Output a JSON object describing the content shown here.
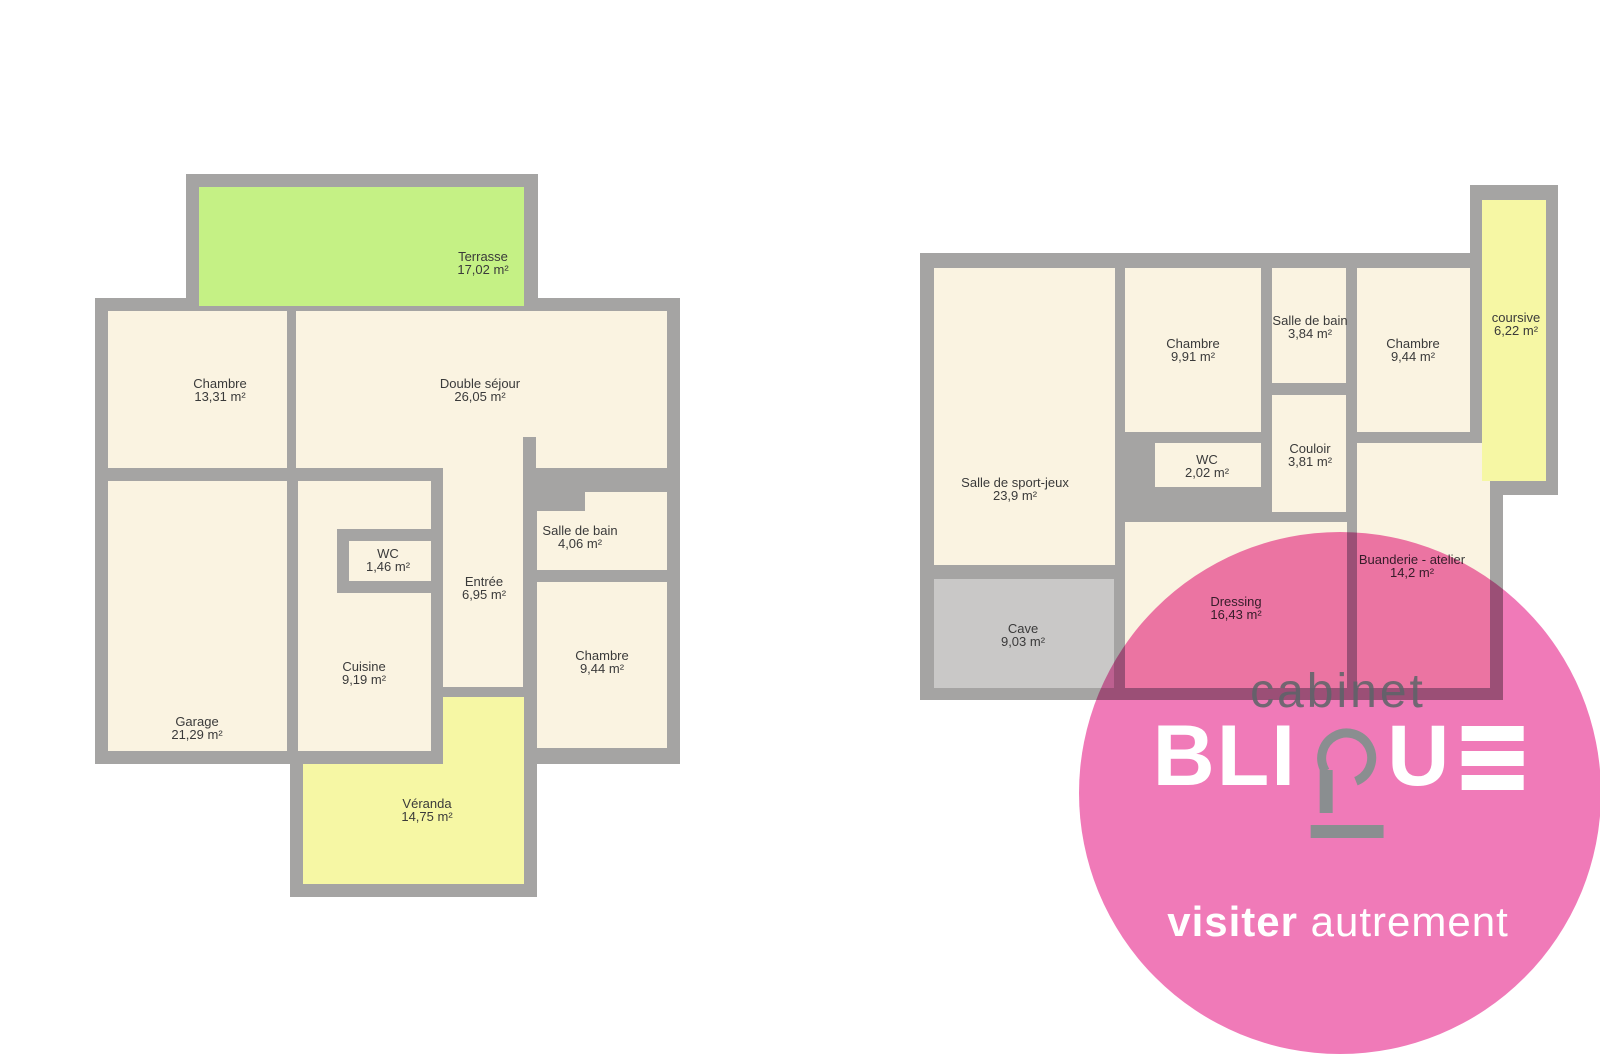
{
  "palette": {
    "wall": "#a5a4a3",
    "room": "#faf3e1",
    "terrace_green": "#c5f185",
    "veranda_yellow": "#f6f7a4",
    "cave_gray": "#c9c8c7",
    "label_text": "#3a3a3a",
    "watermark_pink": "#f07ab8",
    "logo_gray": "#8a8e90",
    "cabinet_text": "#5c6468",
    "logo_white": "#ffffff"
  },
  "floorplans": [
    {
      "id": "plan-left",
      "backings": [
        [
          186,
          174,
          352,
          137
        ],
        [
          95,
          298,
          585,
          466
        ],
        [
          290,
          684,
          247,
          213
        ]
      ],
      "fills": [
        {
          "rect": [
            199,
            187,
            325,
            119
          ],
          "color": "terrace_green"
        },
        {
          "rect": [
            108,
            311,
            179,
            157
          ],
          "color": "room"
        },
        {
          "rect": [
            296,
            311,
            371,
            157
          ],
          "color": "room"
        },
        {
          "rect": [
            108,
            481,
            179,
            270
          ],
          "color": "room"
        },
        {
          "rect": [
            298,
            481,
            133,
            270
          ],
          "color": "room"
        },
        {
          "rect": [
            443,
            468,
            80,
            219
          ],
          "color": "room"
        },
        {
          "rect": [
            537,
            492,
            130,
            78
          ],
          "color": "room"
        },
        {
          "rect": [
            537,
            582,
            130,
            166
          ],
          "color": "room"
        },
        {
          "rect": [
            443,
            697,
            81,
            67
          ],
          "color": "veranda_yellow"
        },
        {
          "rect": [
            303,
            764,
            221,
            120
          ],
          "color": "veranda_yellow"
        }
      ],
      "overlay_walls": [
        [
          337,
          529,
          12,
          64
        ],
        [
          337,
          529,
          94,
          12
        ],
        [
          337,
          581,
          94,
          12
        ],
        [
          523,
          437,
          13,
          31
        ],
        [
          537,
          492,
          48,
          19
        ]
      ],
      "rooms": [
        {
          "name": "Terrasse",
          "area": "17,02 m²",
          "x": 483,
          "y": 251
        },
        {
          "name": "Chambre",
          "area": "13,31 m²",
          "x": 220,
          "y": 378
        },
        {
          "name": "Double séjour",
          "area": "26,05 m²",
          "x": 480,
          "y": 378
        },
        {
          "name": "WC",
          "area": "1,46 m²",
          "x": 388,
          "y": 548
        },
        {
          "name": "Salle de bain",
          "area": "4,06 m²",
          "x": 580,
          "y": 525
        },
        {
          "name": "Entrée",
          "area": "6,95 m²",
          "x": 484,
          "y": 576
        },
        {
          "name": "Cuisine",
          "area": "9,19 m²",
          "x": 364,
          "y": 661
        },
        {
          "name": "Chambre",
          "area": "9,44 m²",
          "x": 602,
          "y": 650
        },
        {
          "name": "Garage",
          "area": "21,29 m²",
          "x": 197,
          "y": 716
        },
        {
          "name": "Véranda",
          "area": "14,75 m²",
          "x": 427,
          "y": 798
        }
      ]
    },
    {
      "id": "plan-right",
      "backings": [
        [
          920,
          253,
          583,
          447
        ],
        [
          1470,
          185,
          88,
          310
        ]
      ],
      "fills": [
        {
          "rect": [
            934,
            268,
            181,
            297
          ],
          "color": "room"
        },
        {
          "rect": [
            934,
            579,
            180,
            109
          ],
          "color": "cave_gray"
        },
        {
          "rect": [
            1125,
            268,
            136,
            164
          ],
          "color": "room"
        },
        {
          "rect": [
            1155,
            443,
            106,
            44
          ],
          "color": "room"
        },
        {
          "rect": [
            1272,
            268,
            74,
            115
          ],
          "color": "room"
        },
        {
          "rect": [
            1272,
            395,
            74,
            117
          ],
          "color": "room"
        },
        {
          "rect": [
            1357,
            268,
            113,
            164
          ],
          "color": "room"
        },
        {
          "rect": [
            1357,
            443,
            133,
            245
          ],
          "color": "room"
        },
        {
          "rect": [
            1125,
            522,
            222,
            166
          ],
          "color": "room"
        },
        {
          "rect": [
            1482,
            200,
            64,
            281
          ],
          "color": "veranda_yellow"
        }
      ],
      "overlay_walls": [],
      "rooms": [
        {
          "name": "Salle de sport-jeux",
          "area": "23,9 m²",
          "x": 1015,
          "y": 477
        },
        {
          "name": "Chambre",
          "area": "9,91 m²",
          "x": 1193,
          "y": 338
        },
        {
          "name": "Salle de bain",
          "area": "3,84 m²",
          "x": 1310,
          "y": 315
        },
        {
          "name": "Chambre",
          "area": "9,44 m²",
          "x": 1413,
          "y": 338
        },
        {
          "name": "coursive",
          "area": "6,22 m²",
          "x": 1516,
          "y": 312
        },
        {
          "name": "WC",
          "area": "2,02 m²",
          "x": 1207,
          "y": 454
        },
        {
          "name": "Couloir",
          "area": "3,81 m²",
          "x": 1310,
          "y": 443
        },
        {
          "name": "Cave",
          "area": "9,03 m²",
          "x": 1023,
          "y": 623
        },
        {
          "name": "Dressing",
          "area": "16,43 m²",
          "x": 1236,
          "y": 596
        },
        {
          "name": "Buanderie - atelier",
          "area": "14,2 m²",
          "x": 1412,
          "y": 554
        }
      ]
    }
  ],
  "watermark": {
    "cabinet": "cabinet",
    "brand": "BLIQUE",
    "brand_prefix": "BLI",
    "brand_mid": "U",
    "tagline_bold": "visiter",
    "tagline_light": "autrement"
  }
}
